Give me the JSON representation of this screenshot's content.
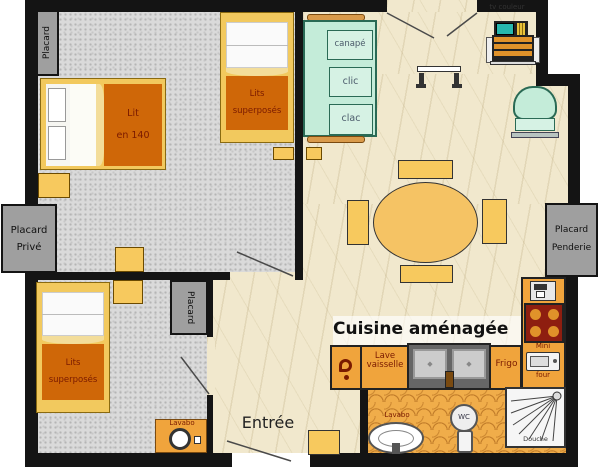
{
  "labels": {
    "placard1": "Placard",
    "lit_line1": "Lit",
    "lit_line2": "en 140",
    "bunk1_line1": "Lits",
    "bunk1_line2": "superposés",
    "canape": "canapé",
    "clic": "clic",
    "clac": "clac",
    "tv": "tv couleur",
    "prive_line1": "Placard",
    "prive_line2": "Privé",
    "placard_center": "Placard",
    "penderie_line1": "Placard",
    "penderie_line2": "Penderie",
    "bunk2_line1": "Lits",
    "bunk2_line2": "superposés",
    "lavabo_bedroom": "Lavabo",
    "cuisine": "Cuisine aménagée",
    "lave_line1": "Lave",
    "lave_line2": "vaisselle",
    "frigo": "Frigo",
    "mini": "Mini",
    "four": "four",
    "entree": "Entrée",
    "lavabo_bath": "Lavabo",
    "wc": "WC",
    "douche": "Douche"
  },
  "colors": {
    "wall": "#141414",
    "bedroom_floor": "#dadada",
    "living_floor": "#f1e8cd",
    "bathroom_floor": "#f0ad4a",
    "counter_orange": "#f0a43c",
    "furniture_yellow": "#f7c95e",
    "blanket_orange": "#cf6708",
    "closet_gray": "#9f9f9f",
    "sofa_mint": "#c4ecd9",
    "stove_red": "#8e1e10",
    "label_red": "#7a1a00",
    "tv_screen_teal": "#27b8ae"
  }
}
